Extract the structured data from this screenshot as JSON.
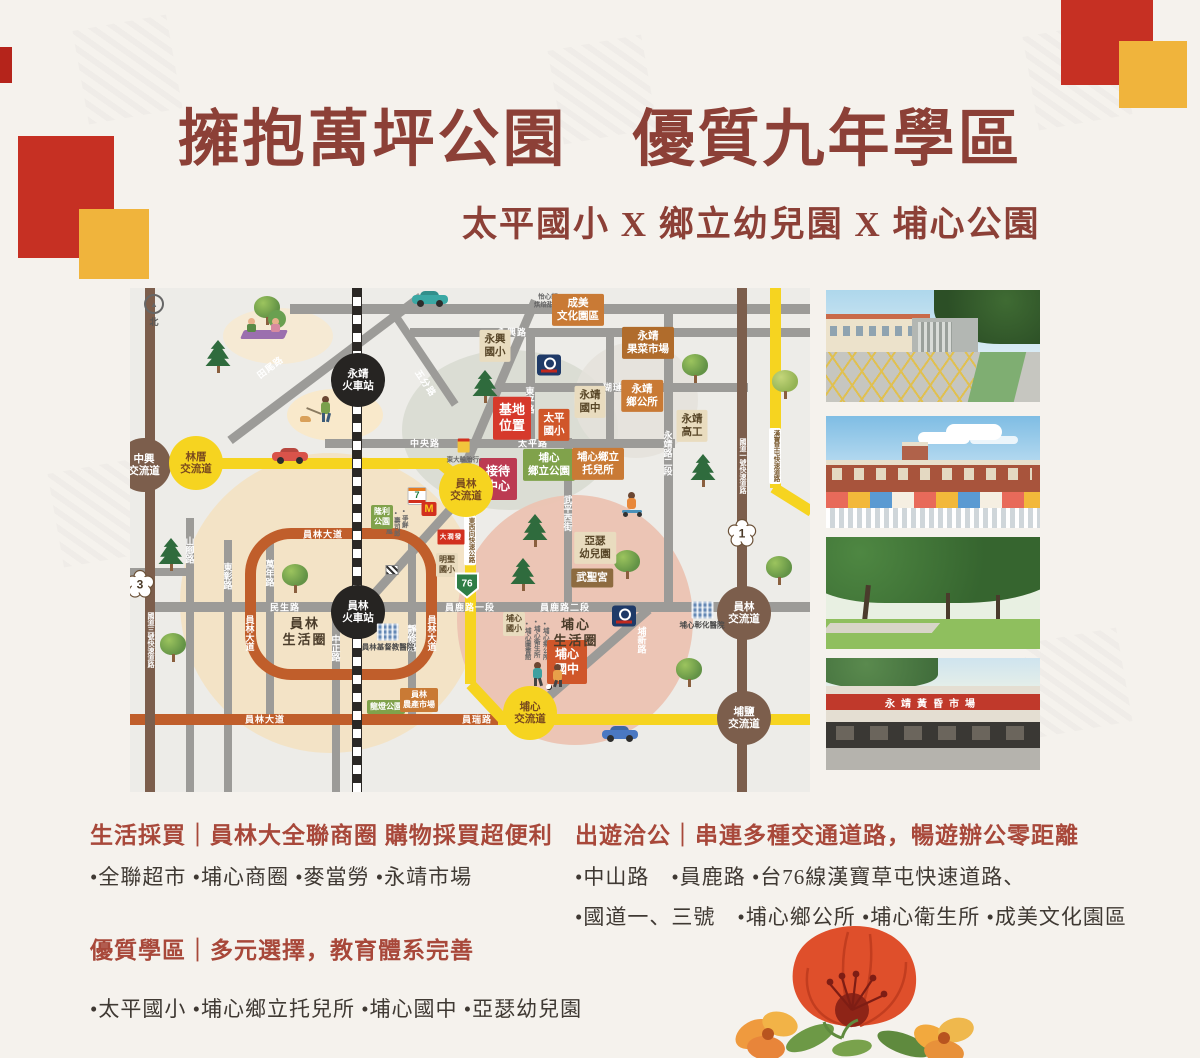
{
  "header": {
    "title": "擁抱萬坪公園　優質九年學區",
    "subtitle": "太平國小 X 鄉立幼兒園 X 埔心公園"
  },
  "sections": {
    "shopping": {
      "heading": "生活採買｜員林大全聯商圈 購物採買超便利",
      "items": "•全聯超市 •埔心商圈 •麥當勞 •永靖市場"
    },
    "school": {
      "heading": "優質學區｜多元選擇，教育體系完善",
      "items": "•太平國小 •埔心鄉立托兒所 •埔心國中 •亞瑟幼兒園"
    },
    "travel": {
      "heading": "出遊洽公｜串連多種交通道路，暢遊辦公零距離",
      "line1": "•中山路　•員鹿路 •台76線漢寶草屯快速道路、",
      "line2": "•國道一、三號　•埔心鄉公所 •埔心衛生所 •成美文化園區"
    }
  },
  "photos": [
    {
      "name": "school-gate-photo"
    },
    {
      "name": "kindergarten-photo"
    },
    {
      "name": "park-photo"
    },
    {
      "name": "market-photo",
      "sign": "永靖黃昏市場"
    }
  ],
  "map": {
    "compass_label": "北",
    "areas": [
      {
        "x": 380,
        "y": 142,
        "rx": 108,
        "ry": 80,
        "c": "#d8dcd1",
        "o": 0.9
      },
      {
        "x": 200,
        "y": 315,
        "rx": 150,
        "ry": 150,
        "c": "#f3e3c4",
        "o": 0.95
      },
      {
        "x": 445,
        "y": 332,
        "rx": 118,
        "ry": 125,
        "c": "#ecc3b2",
        "o": 0.95
      },
      {
        "x": 506,
        "y": 112,
        "rx": 62,
        "ry": 58,
        "c": "#e4e2db",
        "o": 0.85
      },
      {
        "x": 148,
        "y": 48,
        "rx": 55,
        "ry": 28,
        "c": "#f6ead1",
        "o": 0.9
      },
      {
        "x": 205,
        "y": 127,
        "rx": 48,
        "ry": 26,
        "c": "#f9e9c8",
        "o": 0.9
      }
    ],
    "roads": [
      {
        "n": "road-top",
        "x": 160,
        "y": 16,
        "w": 520,
        "h": 10,
        "c": "#9c9b98"
      },
      {
        "n": "road-yongxing",
        "x": 280,
        "y": 40,
        "w": 400,
        "h": 9,
        "c": "#9c9b98"
      },
      {
        "n": "road-hulian",
        "x": 368,
        "y": 95,
        "w": 250,
        "h": 9,
        "c": "#9c9b98"
      },
      {
        "n": "road-central",
        "x": 195,
        "y": 151,
        "w": 350,
        "h": 9,
        "c": "#9c9b98"
      },
      {
        "n": "road-dongping",
        "x": 396,
        "y": 40,
        "w": 9,
        "h": 120,
        "c": "#9c9b98"
      },
      {
        "n": "road-mid-vert",
        "x": 476,
        "y": 40,
        "w": 8,
        "h": 115,
        "c": "#9c9b98"
      },
      {
        "n": "road-wuping",
        "x": 434,
        "y": 150,
        "w": 8,
        "h": 172,
        "c": "#9c9b98"
      },
      {
        "n": "road-yongjing2",
        "x": 534,
        "y": 16,
        "w": 9,
        "h": 306,
        "c": "#9c9b98"
      },
      {
        "n": "road-minsheng-yuanlu",
        "x": 15,
        "y": 314,
        "w": 600,
        "h": 10,
        "c": "#9c9b98"
      },
      {
        "n": "road-yuanlu-east",
        "x": 612,
        "y": 314,
        "w": 68,
        "h": 10,
        "c": "#9c9b98"
      },
      {
        "n": "road-shanjiao",
        "x": 56,
        "y": 230,
        "w": 8,
        "h": 274,
        "c": "#9c9b98"
      },
      {
        "n": "road-dongzhang",
        "x": 94,
        "y": 252,
        "w": 8,
        "h": 252,
        "c": "#9c9b98"
      },
      {
        "n": "road-wannian",
        "x": 136,
        "y": 252,
        "w": 8,
        "h": 178,
        "c": "#9c9b98"
      },
      {
        "n": "road-zhongzheng",
        "x": 202,
        "y": 318,
        "w": 8,
        "h": 186,
        "c": "#9c9b98"
      },
      {
        "n": "road-jingxiu",
        "x": 278,
        "y": 255,
        "w": 8,
        "h": 175,
        "c": "#9c9b98"
      },
      {
        "n": "road-left-short",
        "x": 0,
        "y": 280,
        "w": 58,
        "h": 8,
        "c": "#9c9b98"
      },
      {
        "n": "road-puxin-diag",
        "x": 459,
        "y": 373,
        "w": 158,
        "h": 9,
        "c": "#9c9b98",
        "rot": -41
      },
      {
        "n": "road-station-diag",
        "x": 282,
        "y": 263,
        "w": 165,
        "h": 9,
        "c": "#9c9b98",
        "rot": -48
      },
      {
        "n": "road-upper-diag",
        "x": 365,
        "y": 107,
        "w": 206,
        "h": 9,
        "c": "#9c9b98",
        "rot": -67
      },
      {
        "n": "road-tianwei-diag",
        "x": 195,
        "y": 80,
        "w": 239,
        "h": 9,
        "c": "#9c9b98",
        "rot": -37
      },
      {
        "n": "road-wufen-diag",
        "x": 292,
        "y": 68,
        "w": 117,
        "h": 8,
        "c": "#9c9b98",
        "rot": 56
      },
      {
        "n": "road-yuanlin-blvd-ring",
        "x": 115,
        "y": 240,
        "w": 192,
        "h": 152,
        "ring": 1,
        "c": "#c05e2b"
      },
      {
        "n": "road-yuanlin-blvd-south",
        "x": 0,
        "y": 426,
        "w": 404,
        "h": 11,
        "c": "#c05e2b"
      },
      {
        "n": "hwy76-west",
        "x": 0,
        "y": 170,
        "w": 318,
        "h": 11,
        "c": "#f6d420"
      },
      {
        "n": "hwy76-bend",
        "x": 325,
        "y": 187,
        "w": 42,
        "h": 11,
        "c": "#f6d420",
        "rot": 40
      },
      {
        "n": "hwy76-vert",
        "x": 335,
        "y": 200,
        "w": 11,
        "h": 196,
        "c": "#f6d420"
      },
      {
        "n": "hwy76-curve2",
        "x": 356,
        "y": 413,
        "w": 47,
        "h": 11,
        "c": "#f6d420",
        "rot": 47
      },
      {
        "n": "hwy76-south",
        "x": 368,
        "y": 426,
        "w": 312,
        "h": 11,
        "c": "#f6d420"
      },
      {
        "n": "hwy76-right-vert",
        "x": 640,
        "y": 0,
        "w": 11,
        "h": 200,
        "c": "#f6d420"
      },
      {
        "n": "hwy76-right-curve",
        "x": 662,
        "y": 211,
        "w": 45,
        "h": 11,
        "c": "#f6d420",
        "rot": 32
      },
      {
        "n": "hwy3-vert",
        "x": 15,
        "y": 0,
        "w": 10,
        "h": 504,
        "c": "#7c5e4c"
      },
      {
        "n": "hwy1-vert",
        "x": 607,
        "y": 0,
        "w": 10,
        "h": 504,
        "c": "#7c5e4c"
      },
      {
        "n": "railway",
        "x": 222,
        "y": 0,
        "w": 8,
        "h": 504,
        "c": "#ffffff",
        "rail": 1
      }
    ],
    "road_labels": [
      {
        "t": "永興路",
        "x": 382,
        "y": 44
      },
      {
        "t": "瑚璉路",
        "x": 488,
        "y": 99
      },
      {
        "t": "中央路",
        "x": 295,
        "y": 155
      },
      {
        "t": "太平路",
        "x": 403,
        "y": 155
      },
      {
        "t": "民生路",
        "x": 155,
        "y": 319
      },
      {
        "t": "員鹿路一段",
        "x": 340,
        "y": 319
      },
      {
        "t": "員鹿路二段",
        "x": 435,
        "y": 319
      },
      {
        "t": "員林大道",
        "x": 193,
        "y": 246
      },
      {
        "t": "員林大道",
        "x": 135,
        "y": 431
      },
      {
        "t": "員瑞路",
        "x": 347,
        "y": 431
      },
      {
        "t": "田尾路",
        "x": 140,
        "y": 79,
        "rot": -37
      },
      {
        "t": "五分路",
        "x": 296,
        "y": 95,
        "rot": 56
      },
      {
        "t": "山腳路",
        "x": 60,
        "y": 262,
        "v": 1
      },
      {
        "t": "東彰路",
        "x": 98,
        "y": 288,
        "v": 1
      },
      {
        "t": "萬年路",
        "x": 140,
        "y": 285,
        "v": 1
      },
      {
        "t": "中正路",
        "x": 206,
        "y": 360,
        "v": 1
      },
      {
        "t": "靜修路",
        "x": 282,
        "y": 350,
        "v": 1
      },
      {
        "t": "東平路",
        "x": 400,
        "y": 112,
        "v": 1
      },
      {
        "t": "武平西街",
        "x": 438,
        "y": 225,
        "v": 1
      },
      {
        "t": "永靖路二段",
        "x": 538,
        "y": 165,
        "v": 1
      },
      {
        "t": "埔新路",
        "x": 512,
        "y": 352,
        "v": 1
      },
      {
        "t": "員林大道",
        "x": 120,
        "y": 345,
        "v": 1
      },
      {
        "t": "員林大道",
        "x": 302,
        "y": 345,
        "v": 1
      },
      {
        "t": "國道三號快速道路",
        "x": 20,
        "y": 352,
        "v": 1,
        "fs": 7
      },
      {
        "t": "國道一號快速道路",
        "x": 612,
        "y": 178,
        "v": 1,
        "fs": 7
      },
      {
        "t": "東西向快速公路",
        "x": 340,
        "y": 252,
        "v": 1,
        "box": 1
      },
      {
        "t": "漢寶草屯快速道路",
        "x": 645,
        "y": 168,
        "v": 1,
        "box": 1
      }
    ],
    "circles": [
      {
        "t": "中興\n交流道",
        "x": 14,
        "y": 177,
        "c": "brown",
        "n": "zhongxing-interchange"
      },
      {
        "t": "林厝\n交流道",
        "x": 66,
        "y": 175,
        "c": "yellow",
        "n": "lincuo-interchange"
      },
      {
        "t": "員林\n交流道",
        "x": 336,
        "y": 202,
        "c": "yellow",
        "n": "yuanlin-interchange-76"
      },
      {
        "t": "埔心\n交流道",
        "x": 400,
        "y": 425,
        "c": "yellow",
        "n": "puxin-interchange"
      },
      {
        "t": "員林\n交流道",
        "x": 614,
        "y": 325,
        "c": "brown",
        "n": "yuanlin-interchange-hwy1"
      },
      {
        "t": "埔鹽\n交流道",
        "x": 614,
        "y": 430,
        "c": "brown",
        "n": "puyan-interchange"
      },
      {
        "t": "永靖\n火車站",
        "x": 228,
        "y": 92,
        "c": "black",
        "n": "yongjing-train-station"
      },
      {
        "t": "員林\n火車站",
        "x": 228,
        "y": 324,
        "c": "black",
        "n": "yuanlin-train-station"
      }
    ],
    "shields": [
      {
        "num": "3",
        "x": 10,
        "y": 299,
        "k": "plum"
      },
      {
        "num": "1",
        "x": 612,
        "y": 248,
        "k": "plum"
      },
      {
        "num": "76",
        "x": 337,
        "y": 300,
        "k": "green"
      }
    ],
    "places": [
      {
        "t": "基地\n位置",
        "x": 382,
        "y": 130,
        "s": "red",
        "n": "site-location-label"
      },
      {
        "t": "太平\n國小",
        "x": 424,
        "y": 137,
        "s": "tanred",
        "n": "taiping-elementary-label"
      },
      {
        "t": "接待\n中心",
        "x": 368,
        "y": 191,
        "s": "crimson",
        "n": "reception-center-label"
      },
      {
        "t": "埔心\n鄉立公園",
        "x": 419,
        "y": 177,
        "s": "green",
        "n": "puxin-township-park-label"
      },
      {
        "t": "埔心鄉立\n托兒所",
        "x": 468,
        "y": 176,
        "s": "orange",
        "n": "puxin-nursery-label"
      },
      {
        "t": "成美\n文化園區",
        "x": 448,
        "y": 22,
        "s": "orange",
        "n": "chengmei-culture-park-label"
      },
      {
        "t": "永靖\n果菜市場",
        "x": 518,
        "y": 55,
        "s": "brownorange",
        "n": "yongjing-market-label"
      },
      {
        "t": "永興\n國小",
        "x": 365,
        "y": 58,
        "s": "beige",
        "n": "yongxing-elementary-label"
      },
      {
        "t": "永靖\n國中",
        "x": 460,
        "y": 114,
        "s": "beige",
        "n": "yongjing-junior-high-label"
      },
      {
        "t": "永靖\n鄉公所",
        "x": 512,
        "y": 108,
        "s": "orange",
        "n": "yongjing-township-office-label"
      },
      {
        "t": "永靖\n高工",
        "x": 562,
        "y": 138,
        "s": "beige",
        "n": "yongjing-vocational-school-label"
      },
      {
        "t": "亞瑟\n幼兒園",
        "x": 465,
        "y": 260,
        "s": "beige",
        "n": "arthur-kindergarten-label"
      },
      {
        "t": "武聖宮",
        "x": 462,
        "y": 290,
        "s": "brown",
        "n": "wusheng-temple-label"
      },
      {
        "t": "埔心\n國小",
        "x": 384,
        "y": 336,
        "s": "beige-sm",
        "n": "puxin-elementary-label"
      },
      {
        "t": "埔心\n國中",
        "x": 437,
        "y": 374,
        "s": "tanred-lg",
        "n": "puxin-junior-high-label"
      },
      {
        "t": "明聖\n國小",
        "x": 317,
        "y": 277,
        "s": "beige-sm",
        "n": "mingsheng-elementary-label"
      },
      {
        "t": "隆利\n公園",
        "x": 252,
        "y": 229,
        "s": "green-sm",
        "n": "park-label"
      },
      {
        "t": "龍燈公園",
        "x": 256,
        "y": 419,
        "s": "green-sm",
        "n": "longdeng-park-label"
      },
      {
        "t": "員林\n農產市場",
        "x": 289,
        "y": 412,
        "s": "orange-sm",
        "n": "yuanlin-farm-market-label"
      },
      {
        "t": "員林\n生活圈",
        "x": 175,
        "y": 344,
        "s": "plain",
        "n": "yuanlin-living-circle-label"
      },
      {
        "t": "埔心\n生活圈",
        "x": 446,
        "y": 345,
        "s": "plain",
        "n": "puxin-living-circle-label"
      }
    ],
    "logos": [
      {
        "k": "px",
        "x": 419,
        "y": 77,
        "n": "pxmart-logo"
      },
      {
        "k": "px",
        "x": 494,
        "y": 328,
        "n": "pxmart-logo"
      },
      {
        "k": "711",
        "x": 287,
        "y": 208,
        "n": "seven-eleven-logo"
      },
      {
        "k": "mcd",
        "x": 299,
        "y": 221,
        "n": "mcdonalds-logo"
      },
      {
        "k": "redmart",
        "x": 321,
        "y": 249,
        "t": "大潤發",
        "n": "hypermart-logo"
      },
      {
        "k": "shop",
        "x": 334,
        "y": 163,
        "label": "東大輪胎行•",
        "n": "shop-icon"
      },
      {
        "k": "hosp",
        "x": 258,
        "y": 350,
        "label": "員林基督教醫院",
        "n": "yuanlin-christian-hospital-icon"
      },
      {
        "k": "hosp",
        "x": 572,
        "y": 328,
        "label": "埔心彰化醫院",
        "n": "puxin-changhua-hospital-icon"
      },
      {
        "k": "xsign",
        "x": 262,
        "y": 282,
        "n": "railroad-crossing-sign"
      }
    ],
    "tiny_texts": [
      {
        "t": "怡心軒\n烘焙甜點•",
        "x": 418,
        "y": 14
      },
      {
        "t": "•埔心鄉公所",
        "x": 414,
        "y": 352,
        "v": 1
      },
      {
        "t": "•埔心衛生所",
        "x": 405,
        "y": 350,
        "v": 1
      },
      {
        "t": "•埔心圖書館",
        "x": 396,
        "y": 352,
        "v": 1
      },
      {
        "t": "•爭鮮",
        "x": 273,
        "y": 230,
        "v": 1
      },
      {
        "t": "•壽司郎",
        "x": 265,
        "y": 235,
        "v": 1
      },
      {
        "t": "•50嵐",
        "x": 257,
        "y": 232,
        "v": 1
      }
    ],
    "trees": [
      {
        "x": 75,
        "y": 52,
        "k": 2
      },
      {
        "x": 124,
        "y": 8,
        "k": 1
      },
      {
        "x": 28,
        "y": 250,
        "k": 2
      },
      {
        "x": 30,
        "y": 345,
        "k": 1
      },
      {
        "x": 152,
        "y": 276,
        "k": 1
      },
      {
        "x": 342,
        "y": 82,
        "k": 2
      },
      {
        "x": 552,
        "y": 66,
        "k": 1
      },
      {
        "x": 642,
        "y": 82,
        "k": 3
      },
      {
        "x": 560,
        "y": 166,
        "k": 2
      },
      {
        "x": 636,
        "y": 268,
        "k": 1
      },
      {
        "x": 392,
        "y": 226,
        "k": 2
      },
      {
        "x": 380,
        "y": 270,
        "k": 2
      },
      {
        "x": 484,
        "y": 262,
        "k": 1
      },
      {
        "x": 546,
        "y": 370,
        "k": 1
      }
    ],
    "cars": [
      {
        "x": 142,
        "y": 160,
        "c": "#d9534a",
        "n": "red-car-illustration"
      },
      {
        "x": 282,
        "y": 3,
        "c": "#3aa8a4",
        "n": "teal-car-illustration"
      },
      {
        "x": 472,
        "y": 438,
        "c": "#4a78c2",
        "n": "blue-car-illustration"
      }
    ],
    "figures": [
      {
        "k": "picnic",
        "x": 112,
        "y": 28,
        "n": "picnic-illustration"
      },
      {
        "k": "walker",
        "x": 182,
        "y": 108,
        "n": "dog-walker-illustration"
      },
      {
        "k": "scooter",
        "x": 492,
        "y": 204,
        "n": "scooter-kid-illustration"
      },
      {
        "k": "soccer",
        "x": 404,
        "y": 372,
        "n": "soccer-kids-illustration"
      }
    ]
  }
}
